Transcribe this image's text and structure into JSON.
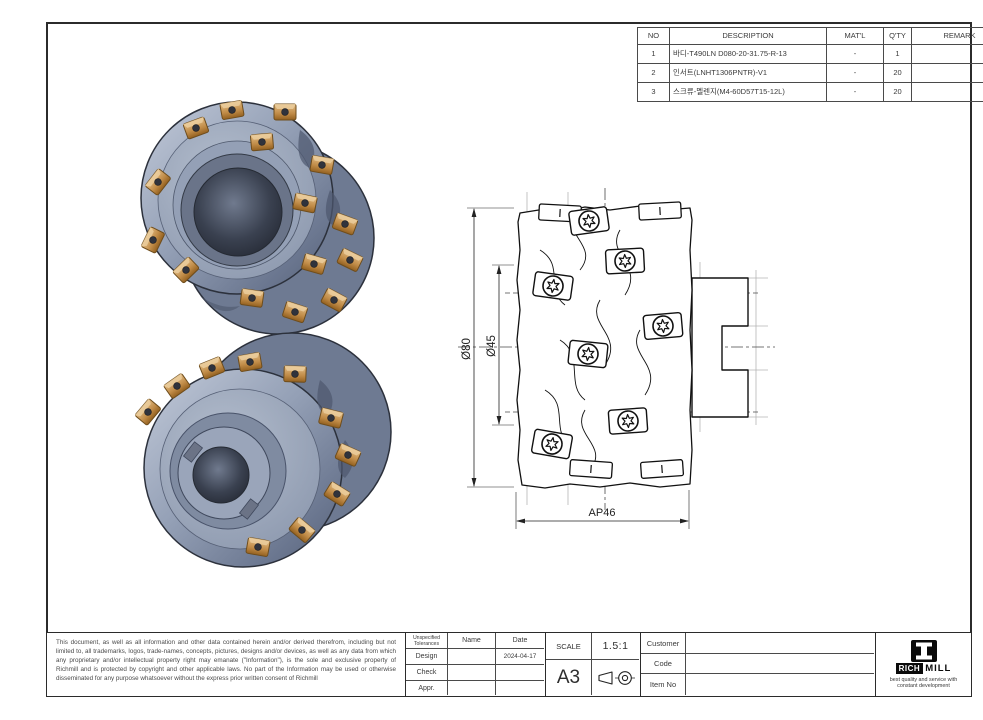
{
  "sheet": {
    "bg": "#ffffff",
    "frame_color": "#2b2b2b"
  },
  "bom_table": {
    "headers": [
      "NO",
      "DESCRIPTION",
      "MAT'L",
      "Q'TY",
      "REMARK"
    ],
    "rows": [
      {
        "no": "1",
        "description": "바디-T490LN D080-20-31.75-R-13",
        "matl": "-",
        "qty": "1",
        "remark": ""
      },
      {
        "no": "2",
        "description": "인서트(LNHT1306PNTR)-V1",
        "matl": "-",
        "qty": "20",
        "remark": ""
      },
      {
        "no": "3",
        "description": "스크류-멜렌지(M4-60D57T15-12L)",
        "matl": "-",
        "qty": "20",
        "remark": ""
      }
    ]
  },
  "views": {
    "dims": {
      "outer": "Ø80",
      "inner": "Ø45",
      "width": "AP46"
    }
  },
  "title_block": {
    "legal": "This document, as well as all information and other data contained herein and/or derived therefrom, including but not limited to, all trademarks, logos, trade-names, concepts, pictures, designs and/or devices, as well as any data from which any proprietary and/or intellectual property right may emanate (\"Information\"), is the sole and exclusive property of Richmill and is protected by copyright and other applicable laws. No part of the Information may be used or otherwise disseminated for any purpose whatsoever without the express prior written consent of Richmill",
    "tol": {
      "header": "Unspecified Tolerances",
      "name_col": "Name",
      "date_col": "Date",
      "rows": [
        {
          "label": "Design",
          "name": "",
          "date": "2024-04-17"
        },
        {
          "label": "Check",
          "name": "",
          "date": ""
        },
        {
          "label": "Appr.",
          "name": "",
          "date": ""
        }
      ]
    },
    "scale": {
      "label": "SCALE",
      "value": "1.5:1",
      "sheet_size": "A3"
    },
    "fields": [
      {
        "label": "Customer",
        "value": ""
      },
      {
        "label": "Code",
        "value": ""
      },
      {
        "label": "Item No",
        "value": ""
      }
    ]
  },
  "logo": {
    "rich": "RICH",
    "mill": "MILL",
    "tagline": "best quality and service with constant development"
  },
  "colors": {
    "steel_light": "#c2cad9",
    "steel_mid": "#94a0b6",
    "steel_dark": "#5d6880",
    "bore_dark": "#23272f",
    "insert_bronze": "#c08b47",
    "insert_bronze_light": "#e3bd85",
    "insert_bronze_dark": "#93601f",
    "screw_dark": "#30333c",
    "drawing_line": "#1a1a1a",
    "construction_gray": "#b5b5b5"
  }
}
